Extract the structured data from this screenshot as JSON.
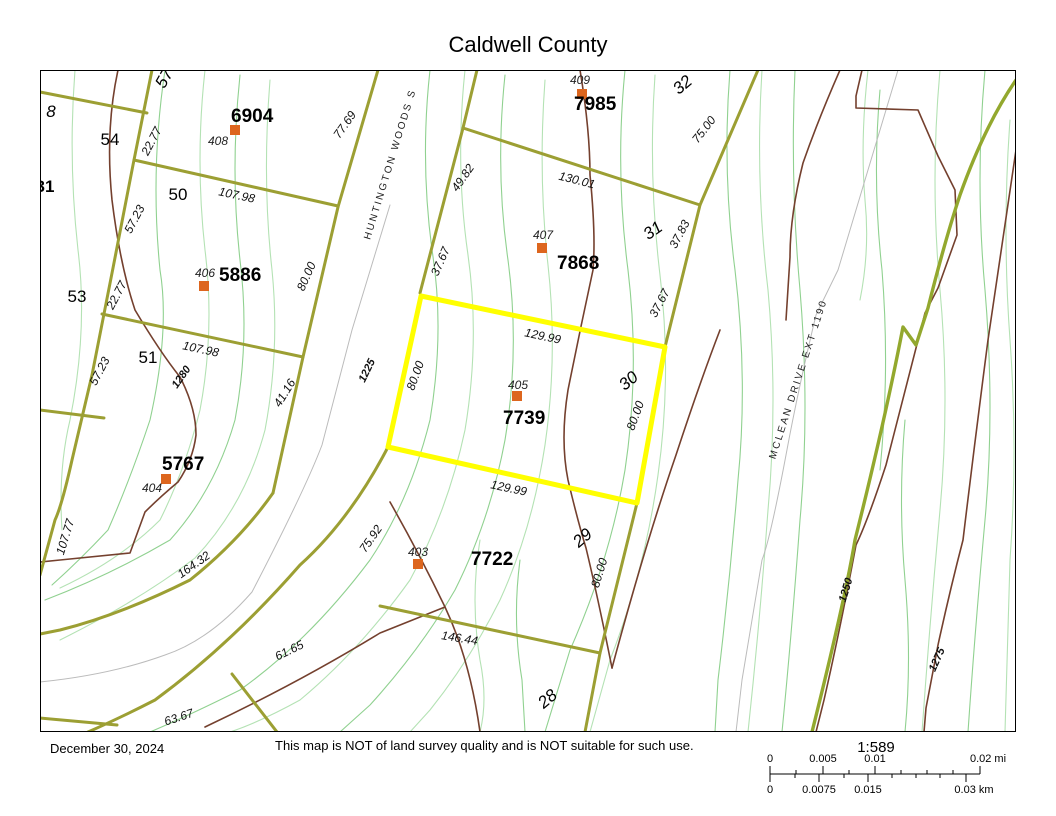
{
  "title": "Caldwell County",
  "footer": {
    "date": "December 30, 2024",
    "disclaimer": "This map is NOT of land survey quality and is NOT suitable for such use.",
    "scale_ratio": "1:589"
  },
  "scale_bar": {
    "mi_labels": [
      {
        "text": "0",
        "x": 770
      },
      {
        "text": "0.005",
        "x": 823
      },
      {
        "text": "0.01",
        "x": 875
      },
      {
        "text": "0.02 mi",
        "x": 988
      }
    ],
    "km_labels": [
      {
        "text": "0",
        "x": 770
      },
      {
        "text": "0.0075",
        "x": 819
      },
      {
        "text": "0.015",
        "x": 868
      },
      {
        "text": "0.03 km",
        "x": 974
      }
    ]
  },
  "map": {
    "colors": {
      "road_olive": "#9C9F33",
      "road_bright": "#93A82E",
      "highlight_yellow": "#FFFF00",
      "contour_green": "#90D190",
      "contour_green_light": "#B4E2B4",
      "contour_brown": "#74402E",
      "centerline_gray": "#BBBBBB",
      "marker_orange": "#DD661E"
    },
    "parcels": [
      {
        "number": "6904",
        "point_id": "408",
        "marker": [
          235,
          130
        ],
        "id_pos": [
          208,
          145
        ],
        "num_pos": [
          231,
          122
        ]
      },
      {
        "number": "7985",
        "point_id": "409",
        "marker": [
          582,
          94
        ],
        "id_pos": [
          570,
          84
        ],
        "num_pos": [
          574,
          110
        ]
      },
      {
        "number": "7868",
        "point_id": "407",
        "marker": [
          542,
          248
        ],
        "id_pos": [
          533,
          239
        ],
        "num_pos": [
          557,
          269
        ]
      },
      {
        "number": "5886",
        "point_id": "406",
        "marker": [
          204,
          286
        ],
        "id_pos": [
          195,
          277
        ],
        "num_pos": [
          219,
          281
        ]
      },
      {
        "number": "5767",
        "point_id": "404",
        "marker": [
          166,
          479
        ],
        "id_pos": [
          142,
          492
        ],
        "num_pos": [
          162,
          470
        ]
      },
      {
        "number": "7739",
        "point_id": "405",
        "marker": [
          517,
          396
        ],
        "id_pos": [
          508,
          389
        ],
        "num_pos": [
          503,
          424
        ]
      },
      {
        "number": "7722",
        "point_id": "403",
        "marker": [
          418,
          564
        ],
        "id_pos": [
          408,
          556
        ],
        "num_pos": [
          471,
          565
        ]
      }
    ],
    "lots": [
      {
        "text": "54",
        "x": 110,
        "y": 145,
        "rot": 0,
        "italic": false,
        "size": 17
      },
      {
        "text": "50",
        "x": 178,
        "y": 200,
        "rot": 0,
        "italic": false,
        "size": 17
      },
      {
        "text": "53",
        "x": 77,
        "y": 302,
        "rot": 0,
        "italic": false,
        "size": 17
      },
      {
        "text": "51",
        "x": 148,
        "y": 363,
        "rot": 0,
        "italic": false,
        "size": 17
      },
      {
        "text": "32",
        "x": 686,
        "y": 89,
        "rot": -40,
        "italic": true,
        "size": 17
      },
      {
        "text": "31",
        "x": 656,
        "y": 235,
        "rot": -35,
        "italic": true,
        "size": 17
      },
      {
        "text": "30",
        "x": 632,
        "y": 385,
        "rot": -40,
        "italic": true,
        "size": 17
      },
      {
        "text": "29",
        "x": 586,
        "y": 542,
        "rot": -40,
        "italic": true,
        "size": 17
      },
      {
        "text": "28",
        "x": 551,
        "y": 703,
        "rot": -40,
        "italic": true,
        "size": 17
      },
      {
        "text": "31",
        "x": 45,
        "y": 192,
        "rot": 0,
        "italic": false,
        "size": 22,
        "bold": true
      },
      {
        "text": "8",
        "x": 51,
        "y": 117,
        "rot": 0,
        "italic": true,
        "size": 11
      },
      {
        "text": "57",
        "x": 169,
        "y": 81,
        "rot": -60,
        "italic": true,
        "size": 12
      }
    ],
    "dims": [
      {
        "text": "22.77",
        "x": 155,
        "y": 143,
        "rot": -62
      },
      {
        "text": "57.23",
        "x": 138,
        "y": 221,
        "rot": -62
      },
      {
        "text": "107.98",
        "x": 236,
        "y": 199,
        "rot": 12
      },
      {
        "text": "77.69",
        "x": 348,
        "y": 127,
        "rot": -55
      },
      {
        "text": "22.77",
        "x": 120,
        "y": 297,
        "rot": -62
      },
      {
        "text": "57.23",
        "x": 103,
        "y": 373,
        "rot": -62
      },
      {
        "text": "107.98",
        "x": 200,
        "y": 353,
        "rot": 12
      },
      {
        "text": "41.16",
        "x": 288,
        "y": 395,
        "rot": -58
      },
      {
        "text": "80.00",
        "x": 310,
        "y": 278,
        "rot": -66
      },
      {
        "text": "49.82",
        "x": 466,
        "y": 180,
        "rot": -55
      },
      {
        "text": "37.67",
        "x": 444,
        "y": 263,
        "rot": -66
      },
      {
        "text": "130.01",
        "x": 576,
        "y": 184,
        "rot": 14
      },
      {
        "text": "75.00",
        "x": 707,
        "y": 132,
        "rot": -52
      },
      {
        "text": "37.83",
        "x": 683,
        "y": 236,
        "rot": -62
      },
      {
        "text": "37.67",
        "x": 663,
        "y": 305,
        "rot": -62
      },
      {
        "text": "129.99",
        "x": 542,
        "y": 340,
        "rot": 12
      },
      {
        "text": "80.00",
        "x": 419,
        "y": 377,
        "rot": -70
      },
      {
        "text": "80.00",
        "x": 639,
        "y": 417,
        "rot": -70
      },
      {
        "text": "129.99",
        "x": 508,
        "y": 492,
        "rot": 12
      },
      {
        "text": "164.32",
        "x": 196,
        "y": 568,
        "rot": -35
      },
      {
        "text": "107.77",
        "x": 69,
        "y": 538,
        "rot": -73
      },
      {
        "text": "75.92",
        "x": 374,
        "y": 541,
        "rot": -55
      },
      {
        "text": "61.65",
        "x": 291,
        "y": 654,
        "rot": -26
      },
      {
        "text": "63.67",
        "x": 180,
        "y": 721,
        "rot": -18
      },
      {
        "text": "146.44",
        "x": 459,
        "y": 642,
        "rot": 9
      },
      {
        "text": "80.00",
        "x": 603,
        "y": 574,
        "rot": -73
      }
    ],
    "contour_labels": [
      {
        "text": "1280",
        "x": 184,
        "y": 379,
        "rot": -55
      },
      {
        "text": "1225",
        "x": 370,
        "y": 372,
        "rot": -64
      },
      {
        "text": "1250",
        "x": 849,
        "y": 591,
        "rot": -73
      },
      {
        "text": "1275",
        "x": 940,
        "y": 661,
        "rot": -66
      }
    ],
    "streets": [
      {
        "text": "HUNTINGTON WOODS S",
        "x": 393,
        "y": 165,
        "rot": -73
      },
      {
        "text": "MCLEAN DRIVE EXT  1190",
        "x": 801,
        "y": 380,
        "rot": -72
      }
    ]
  }
}
